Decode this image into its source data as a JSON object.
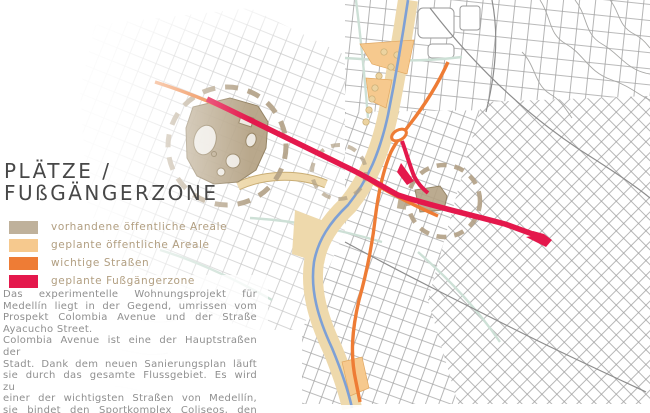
{
  "title": {
    "line1": "PLÄTZE /",
    "line2": "FUßGÄNGERZONE"
  },
  "legend": {
    "items": [
      {
        "label": "vorhandene öffentliche Areale",
        "color": "#bfb19b"
      },
      {
        "label": "geplante öffentliche Areale",
        "color": "#f6c98e"
      },
      {
        "label": "wichtige Straßen",
        "color": "#ee7c35"
      },
      {
        "label": "geplante Fußgängerzone",
        "color": "#e4184c"
      }
    ]
  },
  "description": {
    "lines": [
      {
        "text": "Das experimentelle Wohnungsprojekt für",
        "justify": true
      },
      {
        "text": "Medellín liegt in der Gegend, umrissen vom",
        "justify": true
      },
      {
        "text": "Prospekt Colombia Avenue und der Straße",
        "justify": true
      },
      {
        "text": "Ayacucho Street.",
        "justify": false
      },
      {
        "text": "Colombia Avenue ist eine der Hauptstraßen der",
        "justify": true
      },
      {
        "text": "Stadt. Dank dem neuen Sanierungsplan läuft",
        "justify": true
      },
      {
        "text": "sie durch das gesamte Flussgebiet. Es wird zu",
        "justify": true
      },
      {
        "text": "einer der wichtigsten Straßen von Medellín,",
        "justify": true
      },
      {
        "text": "sie bindet den Sportkomplex Coliseos, den",
        "justify": true
      },
      {
        "text": "Fluss und das Viertel Parque Berrio.",
        "justify": false
      }
    ]
  },
  "colors": {
    "existing-area": "#bfb19b",
    "planned-area": "#f6c98e",
    "street": "#ee7c35",
    "zone": "#e4184c",
    "river": "#7da0d6",
    "corridor": "#eed9ac",
    "map-tan": "#b4a284",
    "tan-outline": "#8d7b5a",
    "dash": "#b1a085",
    "grid-west": "#c9c9c9",
    "grid-east": "#a6a6a6",
    "teal-road": "#cde0d6",
    "title-ink": "#474747",
    "legend-ink": "#b19e80",
    "body-ink": "#8f8f8f"
  }
}
